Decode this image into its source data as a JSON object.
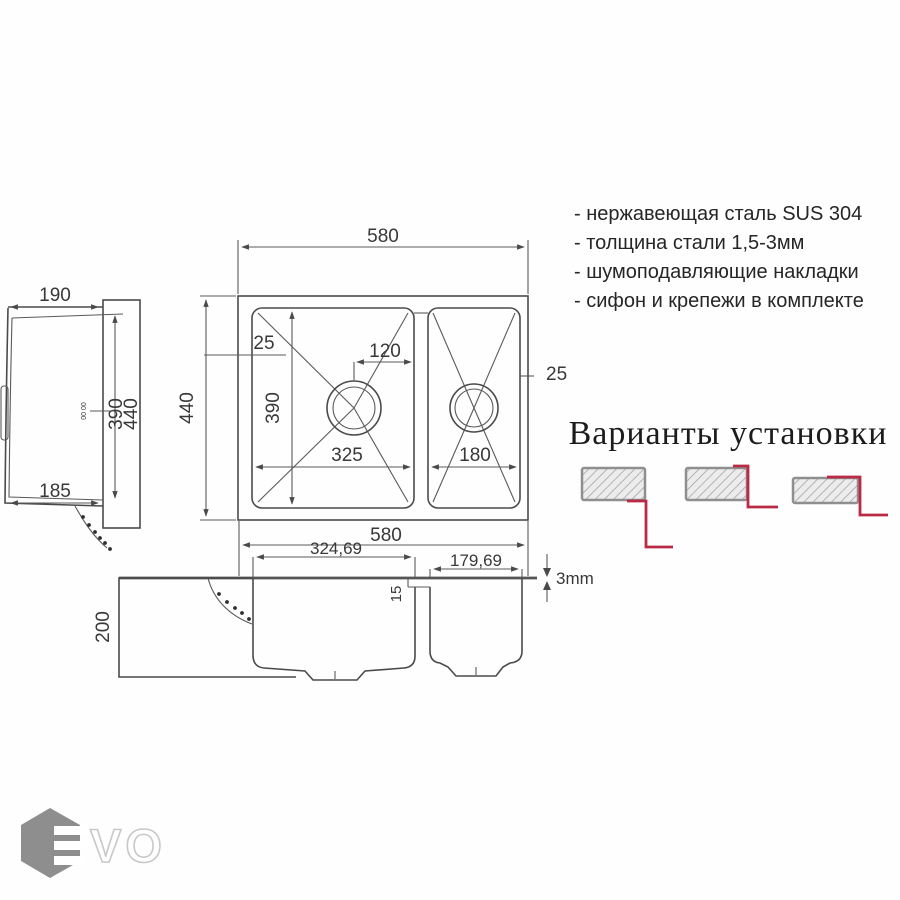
{
  "specs": {
    "items": [
      "- нержавеющая сталь SUS 304",
      "- толщина стали 1,5-3мм",
      "- шумоподавляющие накладки",
      "- сифон и крепежи в комплекте"
    ]
  },
  "installation": {
    "title": "Варианты установки"
  },
  "top_view": {
    "width": "580",
    "height": "440",
    "rim_left": "25",
    "rim_right": "25",
    "drain_offset": "120",
    "bowl_depth": "390",
    "bowl1_width": "325",
    "bowl2_width": "180"
  },
  "side_view": {
    "depth": "190",
    "bottom_depth": "185",
    "inner_height": "390",
    "outer_height": "440",
    "micro_label": "00 00"
  },
  "section_view": {
    "width": "580",
    "bowl1_width": "324,69",
    "bowl2_width": "179,69",
    "rim_thickness": "3mm",
    "divider_offset": "15",
    "cabinet_height": "200"
  },
  "logo": {
    "text": "VO"
  },
  "colors": {
    "accent_red": "#b92b45",
    "line": "#4a4a4a",
    "hatch_border": "#8f8f8f",
    "logo_gray": "#8e8e8e"
  }
}
